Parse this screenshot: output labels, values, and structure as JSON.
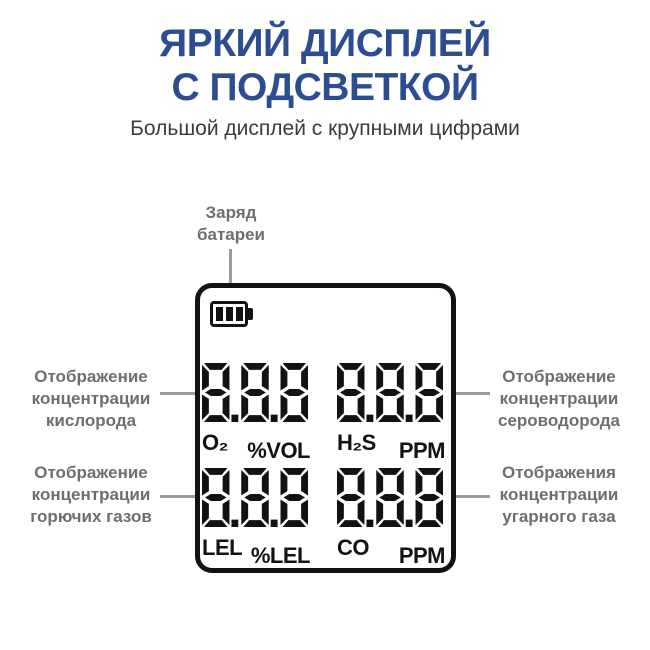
{
  "header": {
    "title_line1": "ЯРКИЙ ДИСПЛЕЙ",
    "title_line2": "С ПОДСВЕТКОЙ",
    "subtitle": "Большой дисплей с крупными цифрами"
  },
  "colors": {
    "title_blue": "#2c4d8f",
    "subtitle_gray": "#3c3c3c",
    "callout_gray": "#6e6e6e",
    "line_gray": "#9b9b9b",
    "dot_blue": "#3a57a5",
    "display_black": "#121212"
  },
  "callouts": {
    "battery": {
      "lines": [
        "Заряд",
        "батареи"
      ]
    },
    "oxygen": {
      "lines": [
        "Отображение",
        "концентрации",
        "кислорода"
      ]
    },
    "h2s": {
      "lines": [
        "Отображение",
        "концентрации",
        "сероводорода"
      ]
    },
    "lel": {
      "lines": [
        "Отображение",
        "концентрации",
        "горючих газов"
      ]
    },
    "co": {
      "lines": [
        "Отображения",
        "концентрации",
        "угарного газа"
      ]
    }
  },
  "device": {
    "battery_icon": "battery-level-3-bars",
    "cells": [
      {
        "id": "o2",
        "digits": "8.8.8",
        "gas": "O₂",
        "unit": "%VOL"
      },
      {
        "id": "h2s",
        "digits": "8.8.8",
        "gas": "H₂S",
        "unit": "PPM"
      },
      {
        "id": "lel",
        "digits": "8.8.8",
        "gas": "LEL",
        "unit": "%LEL"
      },
      {
        "id": "co",
        "digits": "8.8.8",
        "gas": "CO",
        "unit": "PPM"
      }
    ]
  }
}
